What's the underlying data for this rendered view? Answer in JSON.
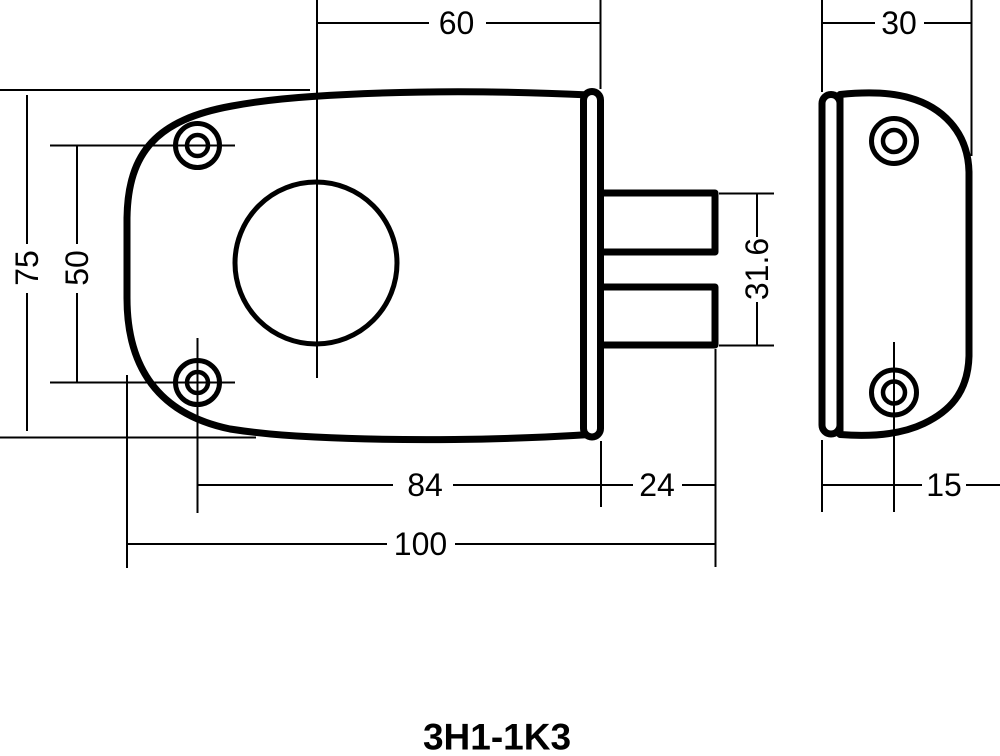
{
  "drawing": {
    "title": "3H1-1K3",
    "background_color": "#ffffff",
    "line_color": "#000000",
    "dimensions": {
      "front_top_width": "60",
      "side_width": "30",
      "body_height": "75",
      "screw_hole_spacing": "50",
      "bolt_overall_height": "31.6",
      "screw_to_faceplate_length": "84",
      "bolt_length": "24",
      "overall_length": "100",
      "side_screw_offset": "15"
    }
  }
}
